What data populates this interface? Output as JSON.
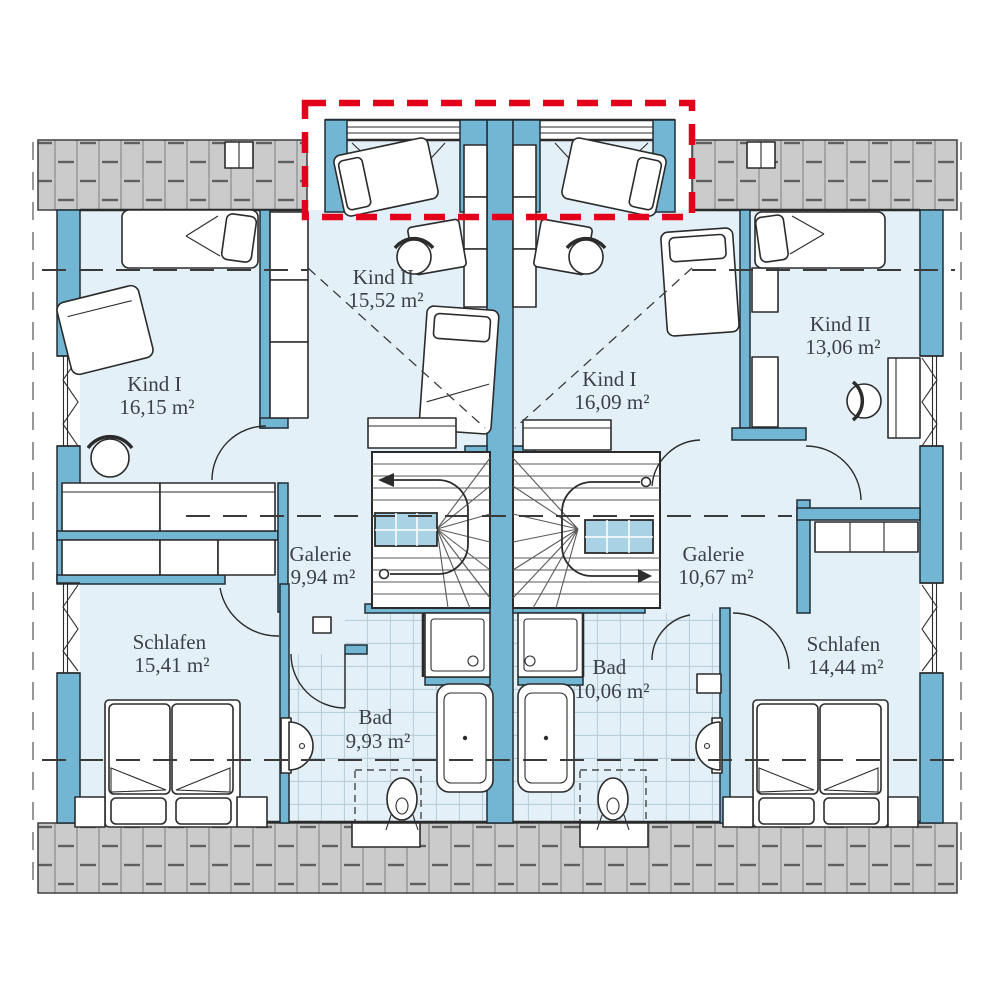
{
  "plan": {
    "colors": {
      "wall": "#72b6d4",
      "floor": "#e4f0f8",
      "roof": "#cbcbcb",
      "highlight": "#e2001a"
    },
    "units": [
      {
        "id": "left",
        "rooms": [
          {
            "id": "kind-1",
            "name": "Kind I",
            "area": "16,15 m²"
          },
          {
            "id": "kind-2",
            "name": "Kind II",
            "area": "15,52 m²"
          },
          {
            "id": "galerie",
            "name": "Galerie",
            "area": "9,94 m²"
          },
          {
            "id": "schlafen",
            "name": "Schlafen",
            "area": "15,41 m²"
          },
          {
            "id": "bad",
            "name": "Bad",
            "area": "9,93 m²"
          }
        ]
      },
      {
        "id": "right",
        "rooms": [
          {
            "id": "kind-1",
            "name": "Kind I",
            "area": "16,09 m²"
          },
          {
            "id": "kind-2",
            "name": "Kind II",
            "area": "13,06 m²"
          },
          {
            "id": "galerie",
            "name": "Galerie",
            "area": "10,67 m²"
          },
          {
            "id": "schlafen",
            "name": "Schlafen",
            "area": "14,44 m²"
          },
          {
            "id": "bad",
            "name": "Bad",
            "area": "10,06 m²"
          }
        ]
      }
    ]
  }
}
